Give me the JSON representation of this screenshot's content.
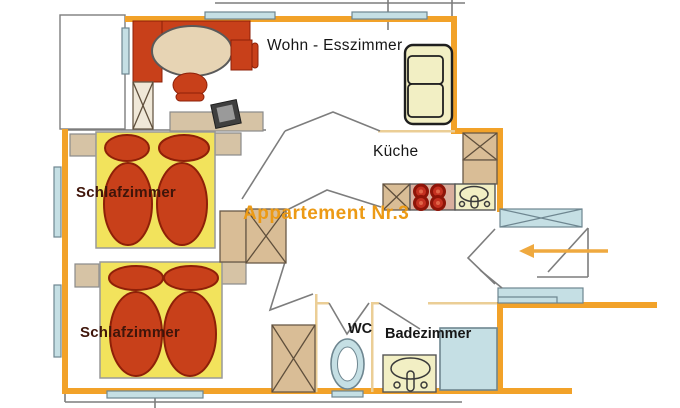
{
  "title": "Appartement Nr.3",
  "labels": {
    "apartment": "Appartement Nr.3",
    "living": "Wohn - Esszimmer",
    "kitchen": "Küche",
    "bedroom1": "Schlafzimmer",
    "bedroom2": "Schlafzimmer",
    "wc": "WC",
    "bathroom": "Badezimmer"
  },
  "furniture_icons": [
    "dining-table-icon",
    "chair-icon",
    "sideboard-icon",
    "tv-icon",
    "sofa-icon",
    "double-bed-icon",
    "pillow-icon",
    "nightstand-icon",
    "wardrobe-icon",
    "kitchen-counter-icon",
    "stove-burners-icon",
    "kitchen-sink-icon",
    "toilet-icon",
    "washbasin-icon",
    "shower-icon",
    "window-icon",
    "door-swing-icon",
    "entrance-arrow-icon",
    "stair-step-icon"
  ],
  "colors": {
    "wall_orange": "#F2A229",
    "wall_pale": "#EBCE96",
    "furniture_red": "#C8401A",
    "furniture_red_dark": "#8E2008",
    "bed_yellow": "#F2E35C",
    "wood_tan": "#D9BD96",
    "beige": "#D6C3A5",
    "table_beige": "#E7D4B4",
    "window_blue": "#C5DFE4",
    "window_blue_stroke": "#6E8690",
    "cream": "#F2EFC4",
    "stove_pink": "#D9AF9E",
    "burner_red": "#C43020",
    "burner_dark": "#8E1408",
    "line_gray": "#7D7D7D",
    "label_dark": "#161616",
    "label_maroon": "#3F150A",
    "accent_orange": "#EC9A15",
    "arrow_orange": "#EFA93F"
  }
}
